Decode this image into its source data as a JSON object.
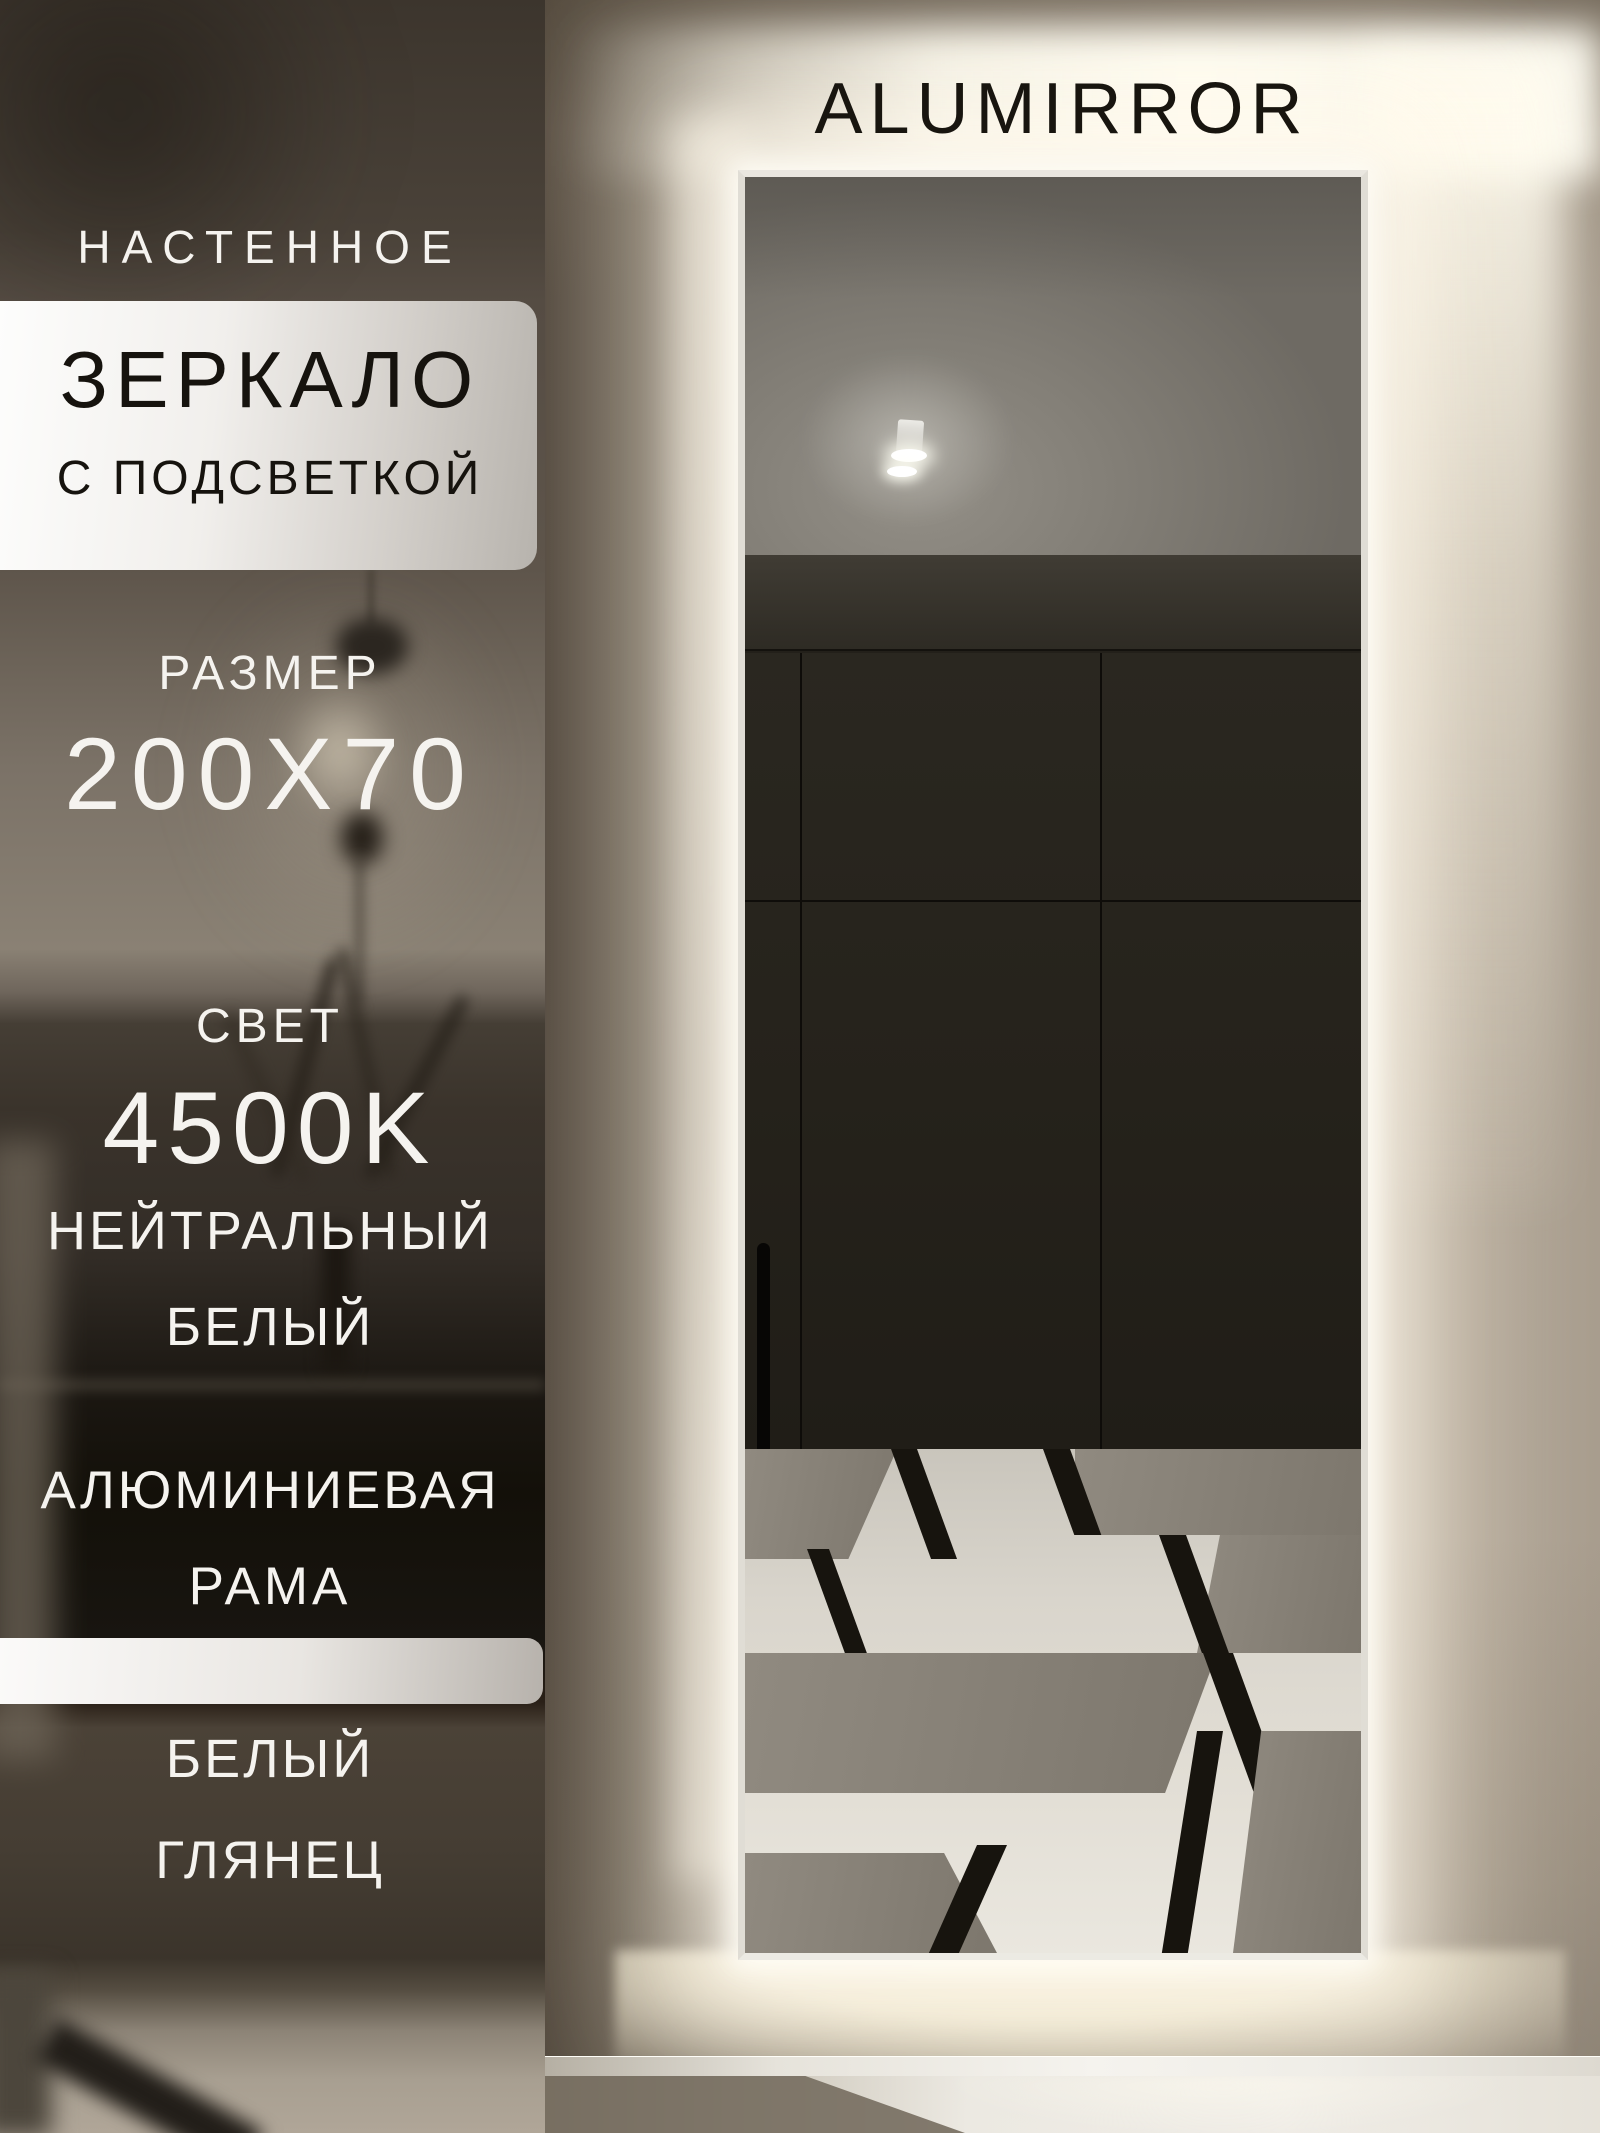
{
  "brand": {
    "name": "ALUMIRROR"
  },
  "badges": {
    "type_label": "НАСТЕННОЕ",
    "product": "ЗЕРКАЛО",
    "feature": "С ПОДСВЕТКОЙ",
    "size_label": "РАЗМЕР",
    "size_value": "200X70",
    "light_label": "СВЕТ",
    "light_value": "4500K",
    "light_desc_line1": "НЕЙТРАЛЬНЫЙ",
    "light_desc_line2": "БЕЛЫЙ",
    "frame_line1": "АЛЮМИНИЕВАЯ",
    "frame_line2": "РАМА",
    "finish_line1": "БЕЛЫЙ",
    "finish_line2": "ГЛЯНЕЦ"
  },
  "colors": {
    "led_glow": "#FFF8E7",
    "text_light": "#F5F3EF",
    "text_dark": "#16130E",
    "banner_start": "#FDFDFC",
    "banner_end": "#B7B3AD",
    "wall": "#9C9183",
    "wardrobe": "#23201A",
    "tile_white": "#E4E1D8",
    "tile_gray": "#8C857B",
    "tile_black": "#17140E"
  }
}
